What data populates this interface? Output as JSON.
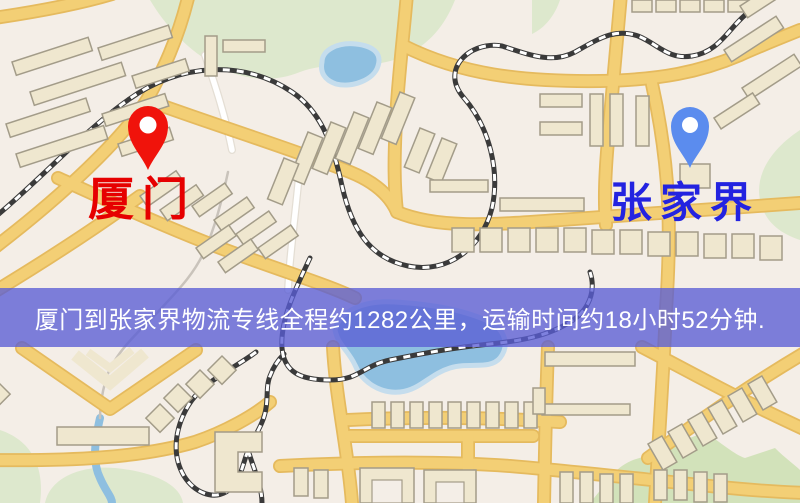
{
  "map": {
    "origin_label": "厦门",
    "destination_label": "张家界",
    "origin_marker_icon": "red-map-pin",
    "destination_marker_icon": "blue-map-pin"
  },
  "banner": {
    "text": "厦门到张家界物流专线全程约1282公里，运输时间约18小时52分钟."
  },
  "colors": {
    "background": "#f4eee7",
    "park": "#dde8cd",
    "park2": "#d2e2ba",
    "water": "#8ebfe0",
    "road": "#f3cf75",
    "road_edge": "#e5ba5e",
    "building": "#efe7cf",
    "building_edge": "#a39c89",
    "rail": "#3a3a3a",
    "origin_label": "#e60000",
    "destination_label": "#2323e0",
    "origin_pin": "#f0130b",
    "destination_pin": "#5b8cee",
    "banner_bg": "rgba(90,94,213,0.78)",
    "banner_text": "#ffffff"
  }
}
